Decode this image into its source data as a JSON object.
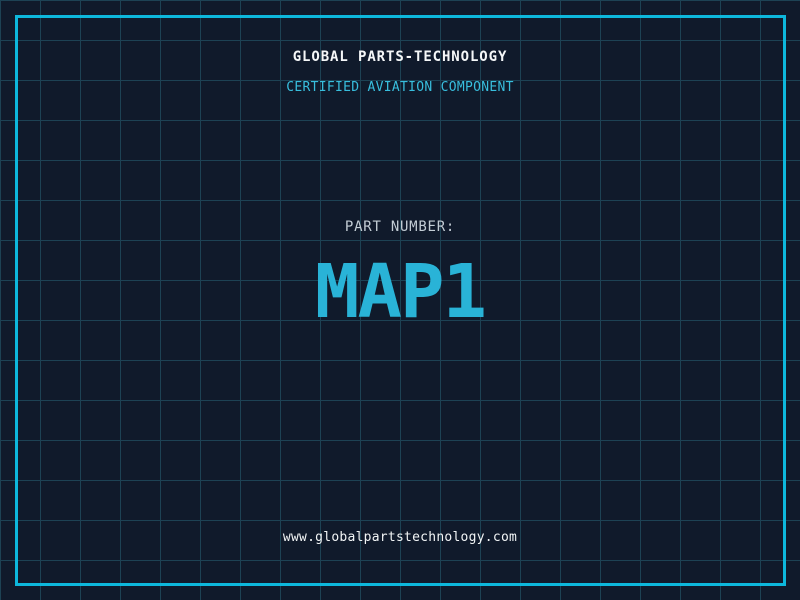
{
  "header": {
    "company": "GLOBAL PARTS-TECHNOLOGY",
    "tagline": "CERTIFIED AVIATION COMPONENT"
  },
  "part": {
    "label": "PART NUMBER:",
    "number": "MAP1"
  },
  "footer": {
    "website": "www.globalpartstechnology.com"
  },
  "colors": {
    "background": "#101a2b",
    "grid_line": "#1d4254",
    "frame_border": "#0db7dc",
    "title_white": "#f5f7f8",
    "tagline_cyan": "#38bedd",
    "label_gray": "#c3cdd5",
    "part_number_cyan": "#29b3d7",
    "url_white": "#f2f5f6"
  }
}
